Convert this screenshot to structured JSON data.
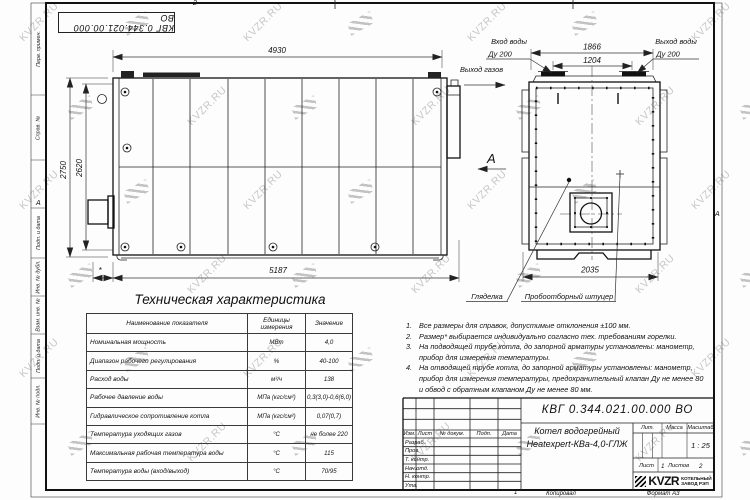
{
  "watermark": {
    "text": "KVZR.RU"
  },
  "frame": {
    "inverted_stamp": "КВГ 0.344.021.00.000 ВО",
    "left_fields": [
      "Перв. примен.",
      "Справ. №",
      "Подп. и дата",
      "Инв. № дубл.",
      "Взам. инв. №",
      "Подп. и дата",
      "Инв. № подл."
    ],
    "zone_top": "2",
    "zone_bottom": "1",
    "zone_left": "А",
    "zone_right": "А",
    "copied_label": "Копировал",
    "format_label": "Формат А3"
  },
  "drawing": {
    "side_view": {
      "dim_top": "4930",
      "dim_height_outer": "2750",
      "dim_height_inner": "2620",
      "dim_star": "*",
      "dim_bottom": "5187",
      "gas_outlet_label": "Выход газов",
      "view_arrow_label": "А"
    },
    "front_view": {
      "dim_top_outer": "1866",
      "dim_top_inner": "1204",
      "dim_bottom": "2035",
      "water_inlet": "Вход воды",
      "water_inlet_dn": "Ду 200",
      "water_outlet": "Выход воды",
      "water_outlet_dn": "Ду 200",
      "sight_glass": "Гляделка",
      "sampling_fitting": "Пробоотборный штуцер"
    }
  },
  "spec_table": {
    "title": "Техническая характеристика",
    "headers": [
      "Наименование показателя",
      "Единицы измерения",
      "Значение"
    ],
    "rows": [
      [
        "Номинальная мощность",
        "МВт",
        "4,0"
      ],
      [
        "Диапазон рабочего регулирования",
        "%",
        "40-100"
      ],
      [
        "Расход воды",
        "м³/ч",
        "138"
      ],
      [
        "Рабочее давление воды",
        "МПа (кгс/см²)",
        "0,3(3,0)-0,6(6,0)"
      ],
      [
        "Гидравлическое сопротивление котла",
        "МПа (кгс/см²)",
        "0,07(0,7)"
      ],
      [
        "Температура уходящих газов",
        "°С",
        "не более 220"
      ],
      [
        "Максимальная рабочая температура воды",
        "°С",
        "115"
      ],
      [
        "Температура воды (вход/выход)",
        "°С",
        "70/95"
      ]
    ]
  },
  "notes": [
    {
      "num": "1.",
      "text": "Все размеры для справок, допустимые отклонения ±100 мм."
    },
    {
      "num": "2.",
      "text": "Размер* выбирается индивидуально согласно тех. требованиям горелки."
    },
    {
      "num": "3.",
      "text": "На подводящей трубе котла, до запорной арматуры установлены: манометр, прибор для измерения температуры."
    },
    {
      "num": "4.",
      "text": "На отводящей трубе котла, до запорной арматуры установлены: манометр, прибор для измерения температуры, предохранительный клапан Ду не менее 80 и обвод с обратным клапаном Ду не менее 80 мм."
    }
  ],
  "title_block": {
    "doc_number": "КВГ 0.344.021.00.000 ВО",
    "title_line1": "Котел водогрейный",
    "title_line2": "Heatexpert-КВа-4,0-ГЛЖ",
    "header_cells": [
      "Изм.",
      "Лист",
      "№ докум.",
      "Подп.",
      "Дата"
    ],
    "row_labels": [
      "Разраб.",
      "Пров.",
      "Т. контр.",
      "Нач.отд.",
      "Н. контр.",
      "Утв."
    ],
    "lit_label": "Лит.",
    "mass_label": "Масса",
    "scale_label": "Масштаб",
    "scale_value": "1 : 25",
    "sheet_label": "Лист",
    "sheet_value": "1",
    "sheets_label": "Листов",
    "sheets_value": "2",
    "logo_text": "KVZR",
    "company_line1": "КОТЕЛЬНЫЙ",
    "company_line2": "ЗАВОД РЭП"
  }
}
